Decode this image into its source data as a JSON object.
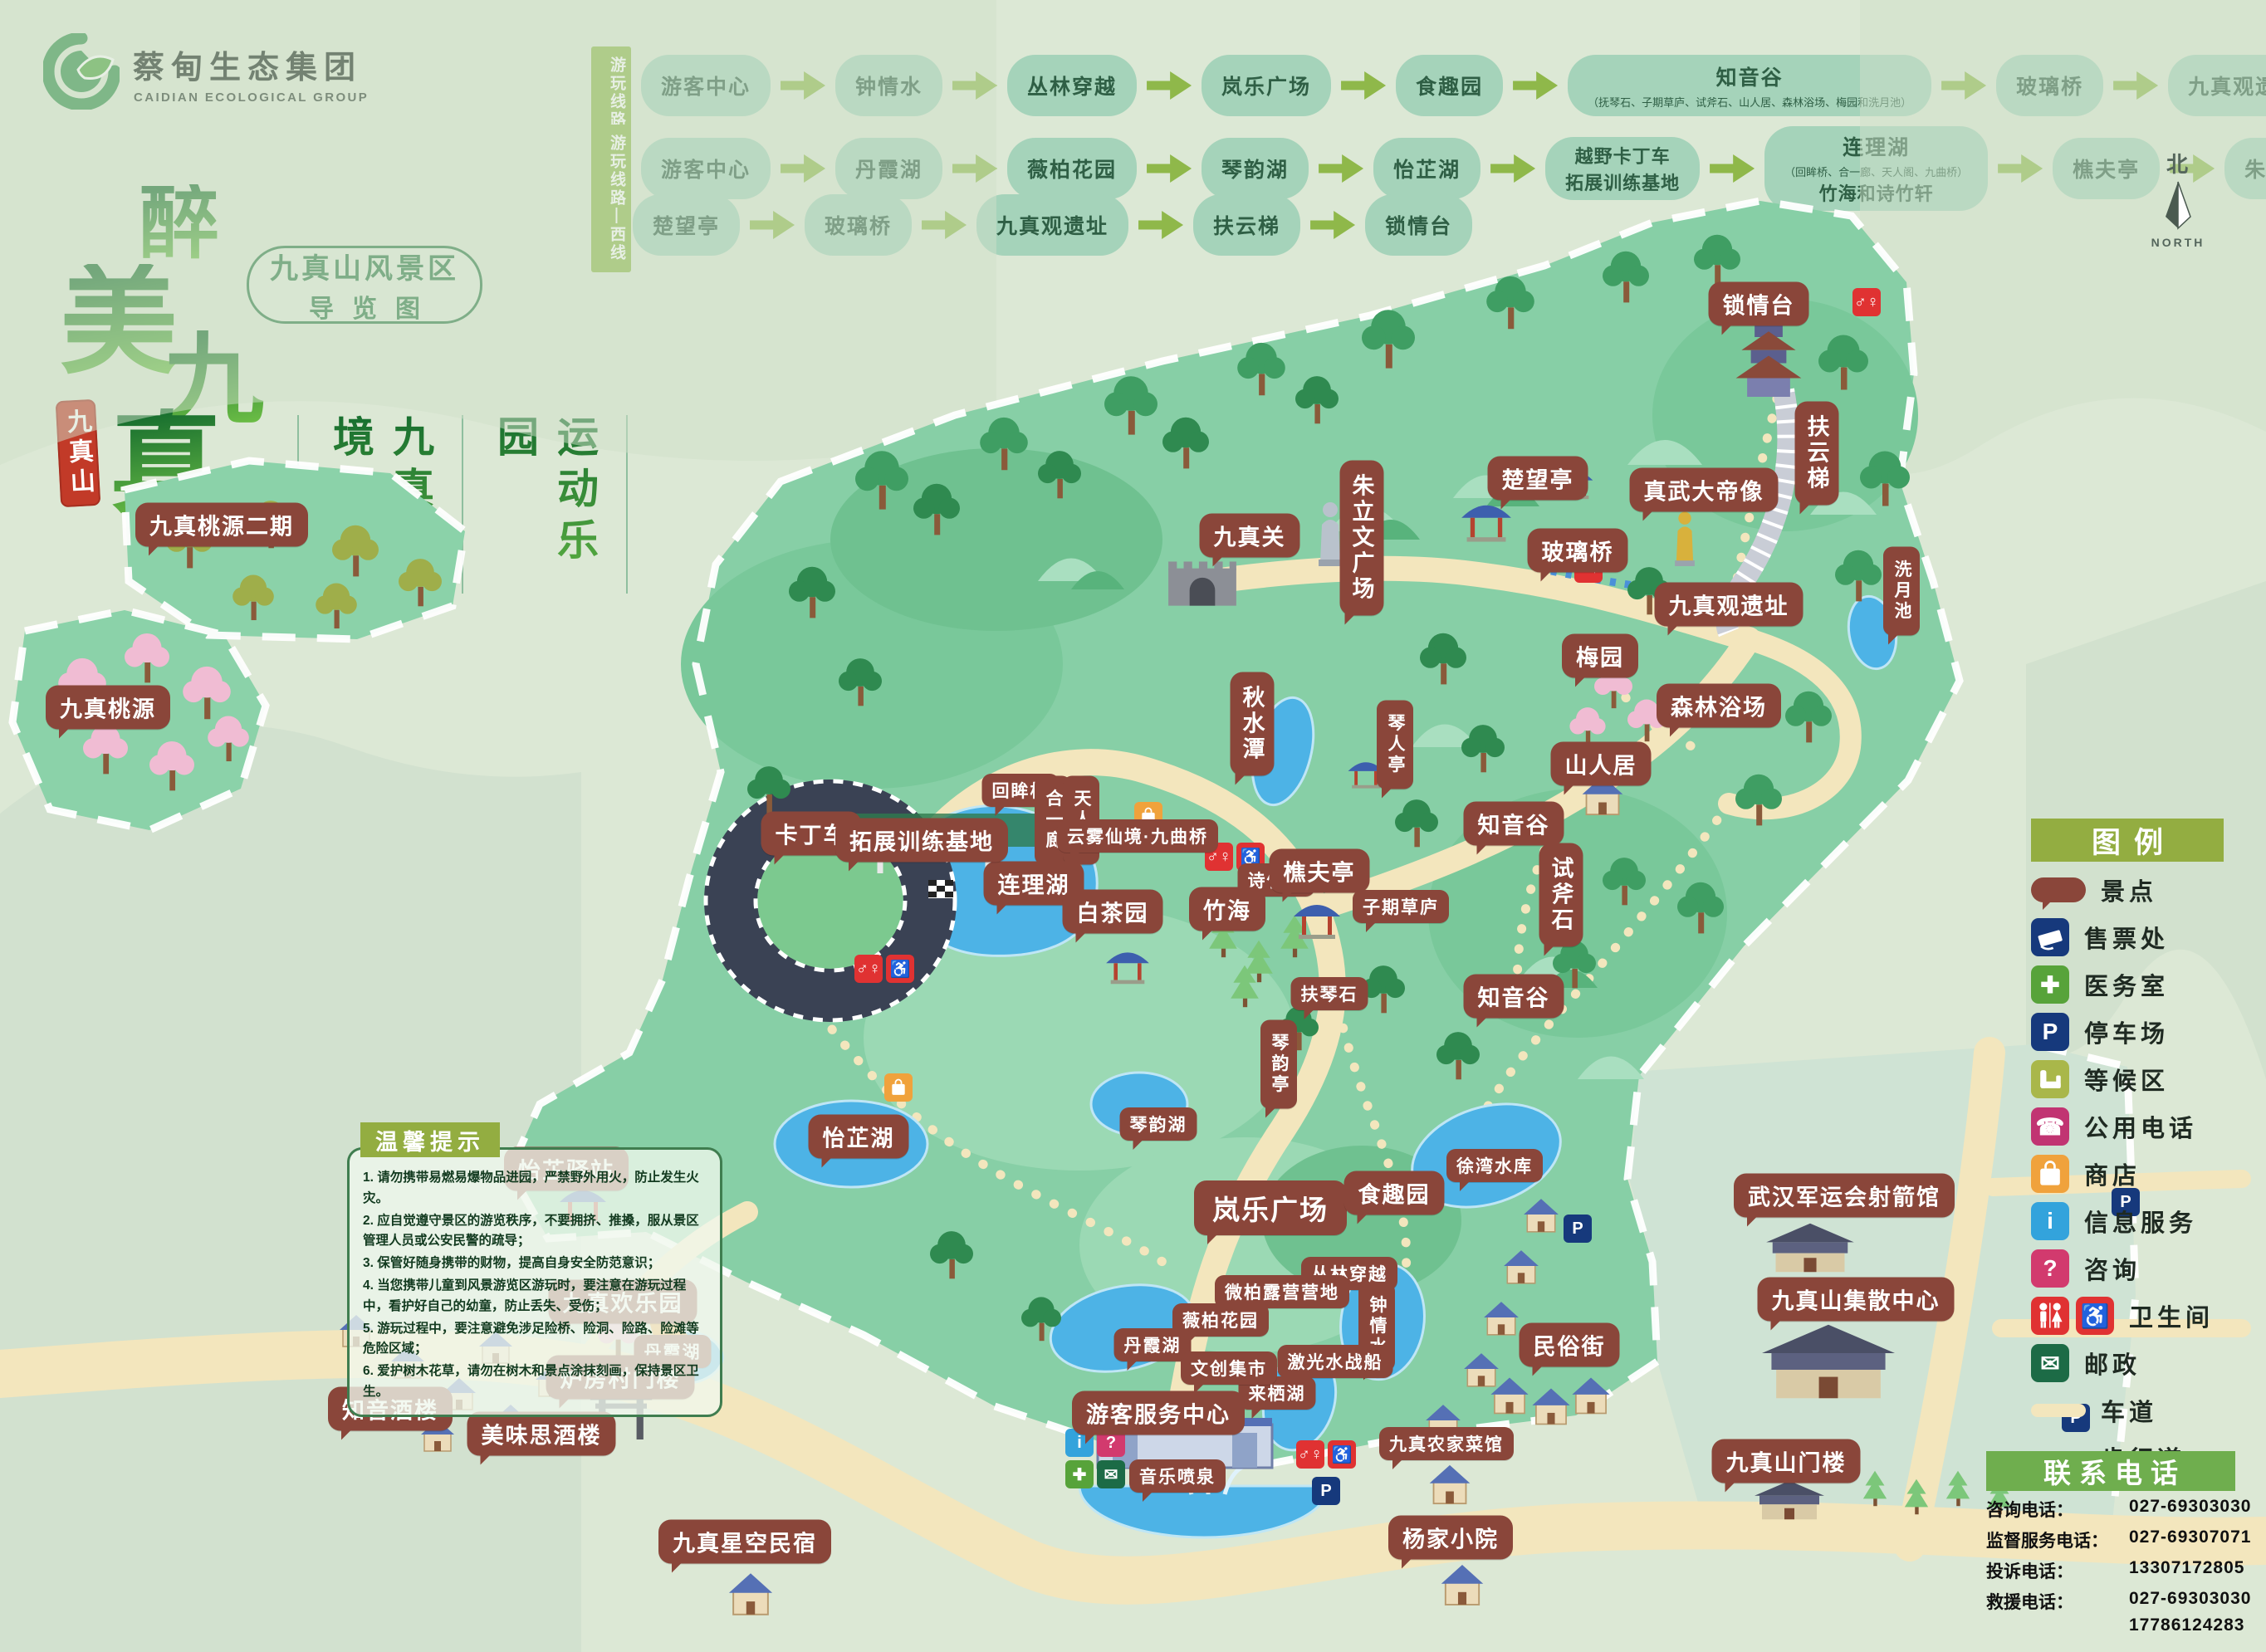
{
  "logo": {
    "title": "蔡甸生态集团",
    "subtitle": "CAIDIAN ECOLOGICAL GROUP"
  },
  "brand": {
    "chars": [
      "醉",
      "美",
      "九",
      "真"
    ],
    "seal": "九真山",
    "badge1": "九真山风景区",
    "badge2": "导览图",
    "slogan1": "九真秘境",
    "slogan2": "运动乐园"
  },
  "routes": {
    "east": {
      "label": "游玩线路—东线",
      "stops": [
        {
          "n": "游客中心"
        },
        {
          "n": "钟情水"
        },
        {
          "n": "丛林穿越"
        },
        {
          "n": "岚乐广场"
        },
        {
          "n": "食趣园"
        },
        {
          "n": "知音谷",
          "note": "（抚琴石、子期草庐、试斧石、山人居、森林浴场、梅园和洗月池）"
        },
        {
          "n": "玻璃桥"
        },
        {
          "n": "九真观遗址"
        },
        {
          "n": "扶云梯"
        },
        {
          "n": "锁情台"
        }
      ]
    },
    "west": {
      "label": "游玩线路—西线",
      "row1": [
        {
          "n": "游客中心"
        },
        {
          "n": "丹霞湖"
        },
        {
          "n": "薇柏花园"
        },
        {
          "n": "琴韵湖"
        },
        {
          "n": "怡芷湖"
        },
        {
          "n": "越野卡丁车",
          "n2": "拓展训练基地"
        },
        {
          "n": "连理湖",
          "note": "（回眸桥、合一廊、天人阁、九曲桥）",
          "note2": "竹海和诗竹轩"
        },
        {
          "n": "樵夫亭"
        },
        {
          "n": "朱立文广场"
        }
      ],
      "row2": [
        {
          "n": "楚望亭"
        },
        {
          "n": "玻璃桥"
        },
        {
          "n": "九真观遗址"
        },
        {
          "n": "扶云梯"
        },
        {
          "n": "锁情台"
        }
      ]
    }
  },
  "map": {
    "labels": [
      "锁情台",
      "扶云梯",
      "真武大帝像",
      "楚望亭",
      "玻璃桥",
      "九真观遗址",
      "洗月池",
      "梅园",
      "森林浴场",
      "山人居",
      "知音谷",
      "试斧石",
      "知音谷",
      "九真关",
      "朱立文广场",
      "秋水潭",
      "琴人亭",
      "诗竹轩",
      "樵夫亭",
      "竹海",
      "子期草庐",
      "扶琴石",
      "回眸桥",
      "合一廊",
      "天人阁",
      "云雾仙境·九曲桥",
      "连理湖",
      "白茶园",
      "卡丁车",
      "拓展训练基地",
      "怡芷湖",
      "琴韵湖",
      "琴韵亭",
      "怡芷驿站",
      "九真桃源二期",
      "九真桃源",
      "岚乐广场",
      "食趣园",
      "徐湾水库",
      "丛林穿越",
      "钟情水",
      "激光水战船",
      "微柏露营营地",
      "薇柏花园",
      "丹霞湖",
      "丹霞湖",
      "来栖湖",
      "文创集市",
      "游客服务中心",
      "音乐喷泉",
      "九真农家菜馆",
      "民俗街",
      "武汉军运会射箭馆",
      "九真山集散中心",
      "九真山门楼",
      "杨家小院",
      "九真星空民宿",
      "九真欢乐园",
      "知音酒楼",
      "美味思酒楼",
      "炉房村门楼"
    ]
  },
  "legend": {
    "title": "图例",
    "items": [
      "景点",
      "售票处",
      "医务室",
      "停车场",
      "等候区",
      "公用电话",
      "商店",
      "信息服务",
      "咨询",
      "卫生间",
      "邮政",
      "车道",
      "步行道"
    ]
  },
  "tips": {
    "title": "温馨提示",
    "items": [
      "1. 请勿携带易燃易爆物品进园，严禁野外用火，防止发生火灾。",
      "2. 应自觉遵守景区的游览秩序，不要拥挤、推搡，服从景区管理人员或公安民警的疏导；",
      "3. 保管好随身携带的财物，提高自身安全防范意识；",
      "4. 当您携带儿童到风景游览区游玩时，要注意在游玩过程中，看护好自己的幼童，防止丢失、受伤；",
      "5. 游玩过程中，要注意避免涉足险桥、险洞、险路、险滩等危险区域；",
      "6. 爱护树木花草，请勿在树木和景点涂抹刻画，保持景区卫生。"
    ]
  },
  "contact": {
    "title": "联系电话",
    "lines": [
      {
        "label": "咨询电话：",
        "value": "027-69303030"
      },
      {
        "label": "监督服务电话：",
        "value": "027-69307071"
      },
      {
        "label": "投诉电话：",
        "value": "13307172805"
      },
      {
        "label": "救援电话：",
        "value": "027-69303030"
      }
    ],
    "extra": "17786124283"
  },
  "compass": {
    "n": "北",
    "label": "NORTH"
  },
  "icons": {
    "wc": "♂♀",
    "accessible": "♿",
    "parking": "P",
    "info": "i",
    "question": "?",
    "medical": "✚",
    "phone": "☎",
    "post": "✉"
  },
  "colors": {
    "background": "#dce8d5",
    "park": "#87cfa6",
    "lake": "#4db3e6",
    "road": "#f3e6bd",
    "bubble": "#8a463a",
    "route_node": "#a5d3ba",
    "olive": "#8fb84a",
    "legend_header": "#93ad41",
    "contact_header": "#6fae4e",
    "seal_red": "#c23a28",
    "title_green": "#2e7d46"
  }
}
